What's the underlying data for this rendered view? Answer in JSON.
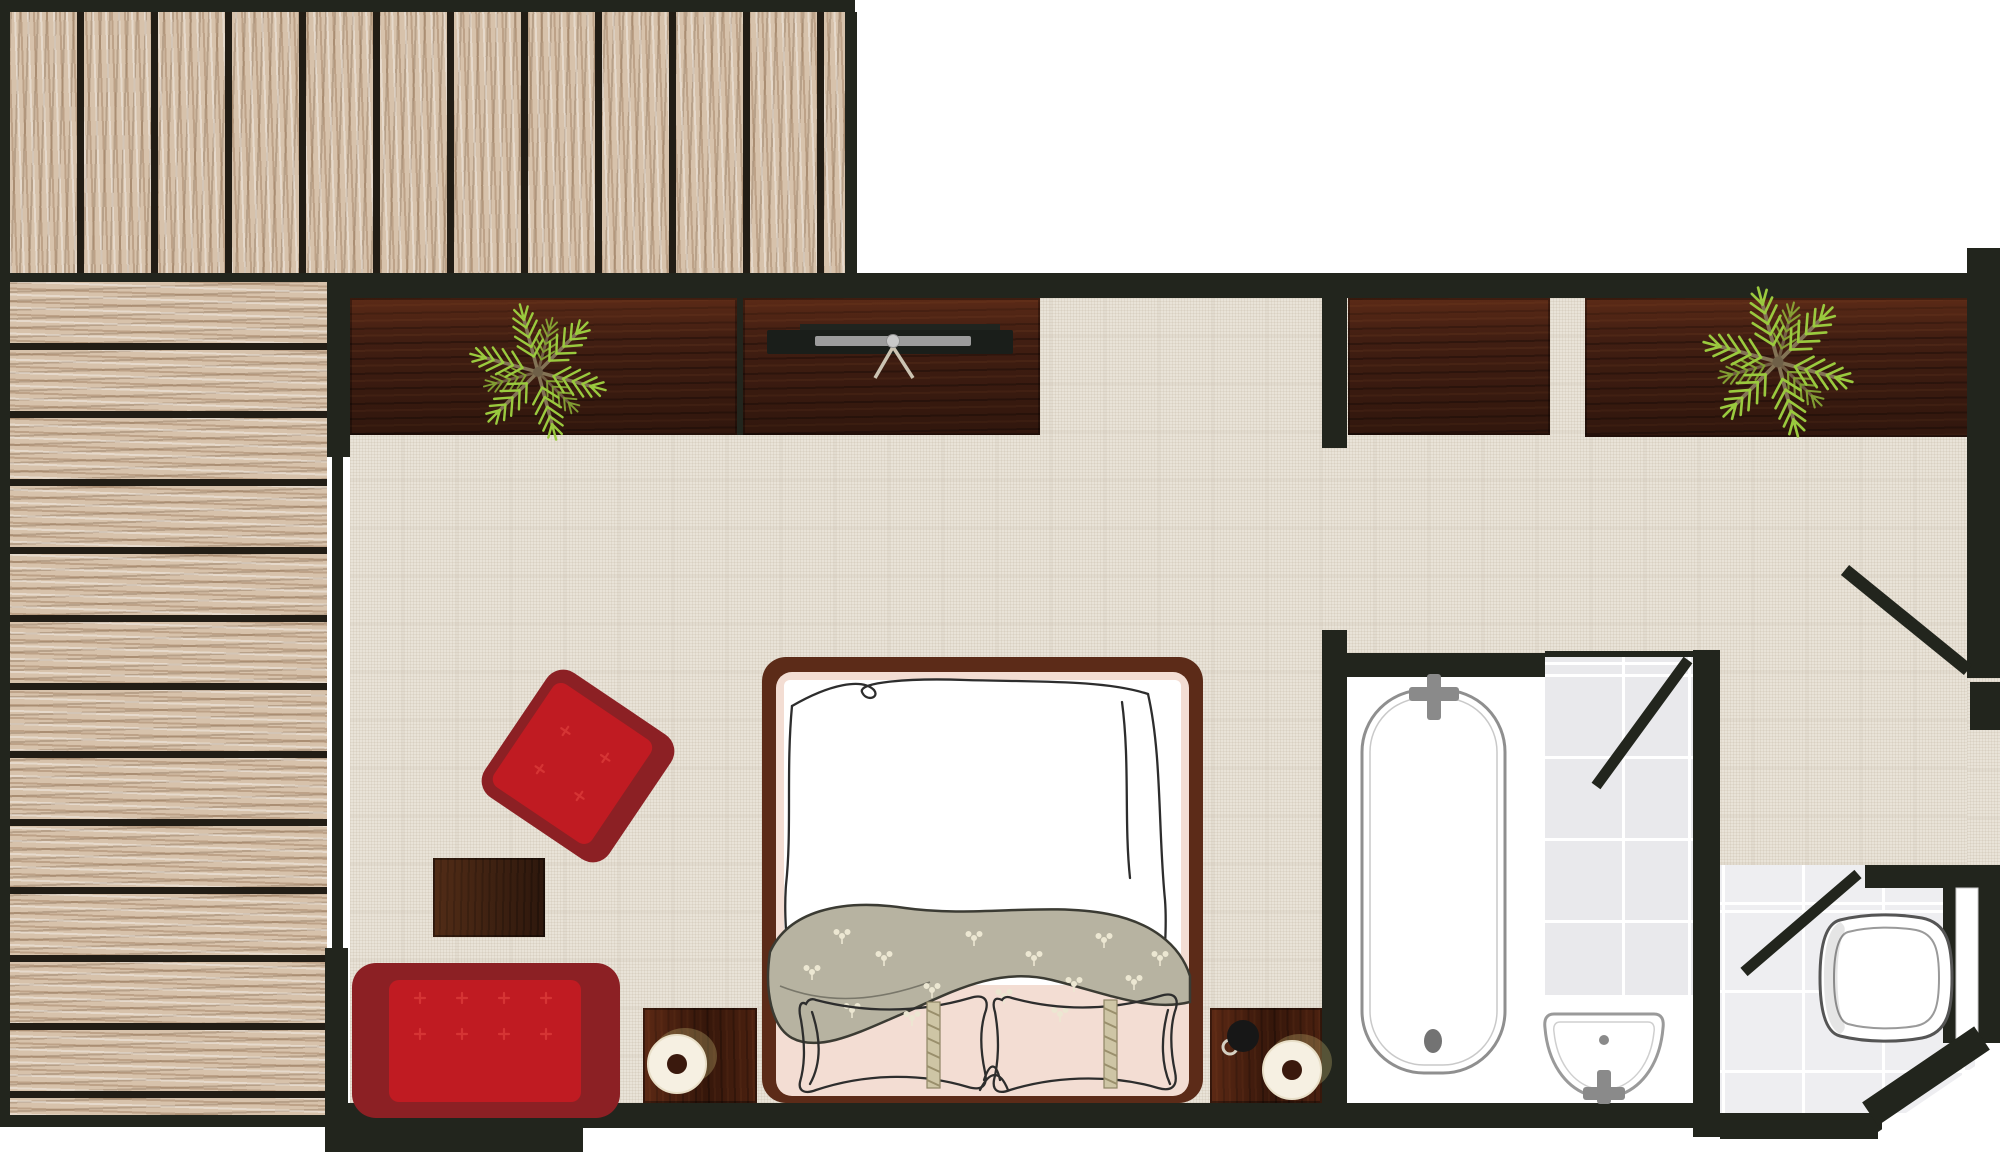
{
  "meta": {
    "kind": "hotel-room-floor-plan-top-view",
    "rooms": [
      "terrace-deck",
      "bedroom",
      "bathroom",
      "shower",
      "wc"
    ],
    "fixtures": [
      "double-bed",
      "red-sofa",
      "red-armchair",
      "coffee-table",
      "nightstand-left",
      "nightstand-right",
      "table-lamp-left",
      "table-lamp-right",
      "coffee-mug",
      "tv-console",
      "flat-tv",
      "potted-plant-left",
      "potted-plant-right",
      "bathtub",
      "washbasin",
      "toilet",
      "entrance-door",
      "shower-door",
      "wc-door"
    ]
  },
  "colors": {
    "wall": "#22251d",
    "floorLinen": "#e9e3d8",
    "deckWood": "#d7c2ab",
    "deckSeam": "#221d15",
    "cabinetWood": "#4a2315",
    "nightstandWood": "#451e0e",
    "tableWood": "#3f2212",
    "bedFrame": "#5c2b18",
    "mattress": "#f3ddd3",
    "duvet": "#ffffff",
    "runner": "#b7b3a1",
    "runnerOutline": "#3b3b33",
    "floral": "#ece7d2",
    "sketch": "#2d2d2d",
    "redDark": "#8c2024",
    "redBright": "#c01b22",
    "tuft": "#d53434",
    "showerTile": "#e9e9ec",
    "wcTile": "#eeeef1",
    "tileLine": "#ffffff",
    "bathFloor": "#ffffff",
    "fixtureLine": "#8f8f8f",
    "faucet": "#8a8a8a",
    "toiletLine": "#555555",
    "plantGreen": "#9aca3e",
    "plantStem": "#837355",
    "lampShade": "#f6f0e2",
    "lampHole": "#3a190d",
    "mug": "#171717",
    "tvPanel": "#1a1e1a",
    "tvBar": "#9c9c9c",
    "tvLeg": "#cbc3b2",
    "rope": "#cec5a5",
    "ropeHatch": "#9a8f6c"
  },
  "layout": {
    "floors": [
      {
        "n": "terrace-deck-planks-vertical",
        "cls": "deck-v",
        "x": 10,
        "y": 12,
        "w": 835,
        "h": 261
      },
      {
        "n": "terrace-deck-planks-horizontal",
        "cls": "deck-h",
        "x": 10,
        "y": 282,
        "w": 317,
        "h": 833
      },
      {
        "n": "bedroom-floor",
        "cls": "floor-linen",
        "x": 350,
        "y": 298,
        "w": 1617,
        "h": 805
      },
      {
        "n": "entrance-doorway-floor",
        "cls": "floor-linen",
        "x": 1967,
        "y": 678,
        "w": 33,
        "h": 187
      },
      {
        "n": "bathroom-floor",
        "cls": "floor-white",
        "x": 1347,
        "y": 677,
        "w": 346,
        "h": 426
      },
      {
        "n": "shower-floor-tiles",
        "cls": "floor-shower",
        "x": 1545,
        "y": 655,
        "w": 148,
        "h": 340
      },
      {
        "n": "wc-floor-tiles",
        "cls": "floor-wc",
        "x": 1720,
        "y": 865,
        "w": 255,
        "h": 248
      }
    ],
    "furniture": [
      {
        "n": "wardrobe-shelf-left",
        "cls": "cabinet",
        "x": 350,
        "y": 298,
        "w": 387,
        "h": 137
      },
      {
        "n": "tv-console",
        "cls": "cabinet",
        "x": 743,
        "y": 298,
        "w": 297,
        "h": 137
      },
      {
        "n": "wardrobe-shelf-middle",
        "cls": "cabinet",
        "x": 1348,
        "y": 298,
        "w": 202,
        "h": 137
      },
      {
        "n": "wardrobe-shelf-right",
        "cls": "cabinet",
        "x": 1585,
        "y": 298,
        "w": 385,
        "h": 139
      },
      {
        "n": "nightstand-left",
        "cls": "nightstand",
        "x": 643,
        "y": 1008,
        "w": 114,
        "h": 95
      },
      {
        "n": "nightstand-right",
        "cls": "nightstand",
        "x": 1210,
        "y": 1008,
        "w": 112,
        "h": 95
      },
      {
        "n": "coffee-table",
        "cls": "side-table",
        "x": 433,
        "y": 858,
        "w": 112,
        "h": 79
      }
    ],
    "walls": [
      {
        "n": "wall-terrace-top",
        "x": 0,
        "y": 0,
        "w": 855,
        "h": 12
      },
      {
        "n": "wall-terrace-left",
        "x": 0,
        "y": 0,
        "w": 10,
        "h": 1122
      },
      {
        "n": "wall-terrace-right",
        "x": 845,
        "y": 12,
        "w": 12,
        "h": 263
      },
      {
        "n": "wall-terrace-plank-seam",
        "x": 10,
        "y": 273,
        "w": 317,
        "h": 9
      },
      {
        "n": "wall-top-main",
        "x": 327,
        "y": 273,
        "w": 1640,
        "h": 25
      },
      {
        "n": "wall-left-upper",
        "x": 327,
        "y": 273,
        "w": 23,
        "h": 184
      },
      {
        "n": "wall-left-middle",
        "x": 332,
        "y": 457,
        "w": 11,
        "h": 495
      },
      {
        "n": "wall-left-pillar",
        "x": 325,
        "y": 948,
        "w": 23,
        "h": 204
      },
      {
        "n": "wall-left-bottom-block",
        "x": 325,
        "y": 1103,
        "w": 258,
        "h": 49
      },
      {
        "n": "wall-terrace-bottom",
        "x": 0,
        "y": 1115,
        "w": 327,
        "h": 12
      },
      {
        "n": "wall-bottom-main",
        "x": 327,
        "y": 1103,
        "w": 1393,
        "h": 25
      },
      {
        "n": "wall-bathroom-stub",
        "x": 1322,
        "y": 298,
        "w": 25,
        "h": 150
      },
      {
        "n": "wall-bathroom-left",
        "x": 1322,
        "y": 630,
        "w": 25,
        "h": 473
      },
      {
        "n": "wall-tub-top",
        "x": 1347,
        "y": 653,
        "w": 198,
        "h": 24
      },
      {
        "n": "wall-bath-divider",
        "x": 1693,
        "y": 650,
        "w": 27,
        "h": 487
      },
      {
        "n": "wall-right",
        "x": 1967,
        "y": 248,
        "w": 33,
        "h": 430
      },
      {
        "n": "wall-entrance-jamb",
        "x": 1970,
        "y": 682,
        "w": 30,
        "h": 48
      },
      {
        "n": "wall-wc-top",
        "x": 1865,
        "y": 865,
        "w": 135,
        "h": 23
      },
      {
        "n": "wall-wc-right",
        "x": 1943,
        "y": 865,
        "w": 57,
        "h": 178
      },
      {
        "n": "wall-wc-bottom",
        "x": 1720,
        "y": 1113,
        "w": 162,
        "h": 26
      },
      {
        "n": "wall-cabinet-divider",
        "x": 737,
        "y": 298,
        "w": 6,
        "h": 137
      }
    ]
  }
}
